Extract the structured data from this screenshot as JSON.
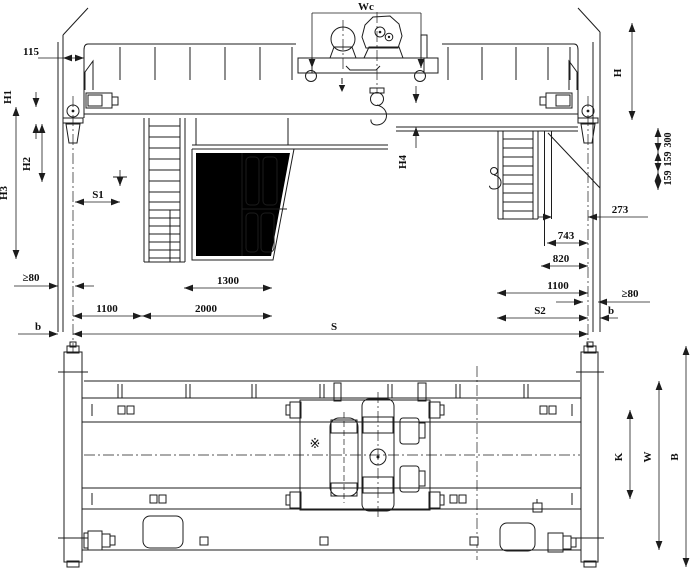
{
  "drawing": {
    "subject": "double-girder overhead bridge crane general arrangement",
    "views": [
      "front elevation",
      "plan"
    ],
    "line_color": "#1c1c1c",
    "background": "#ffffff"
  },
  "labels": {
    "wc": "Wc",
    "offset115": "115",
    "h1": "H1",
    "h2": "H2",
    "h3": "H3",
    "h4": "H4",
    "h": "H",
    "s1": "S1",
    "s": "S",
    "s2": "S2",
    "clearance_left": "≥80",
    "clearance_right": "≥80",
    "b_left": "b",
    "b_right": "b",
    "d1100_left": "1100",
    "d2000": "2000",
    "d1300": "1300",
    "d300": "300",
    "d159_upper": "159",
    "d159_lower": "159",
    "d273": "273",
    "d743": "743",
    "d820": "820",
    "d1100_right": "1100",
    "k": "K",
    "w": "W",
    "b_overall": "B",
    "ref_mark": "※"
  }
}
